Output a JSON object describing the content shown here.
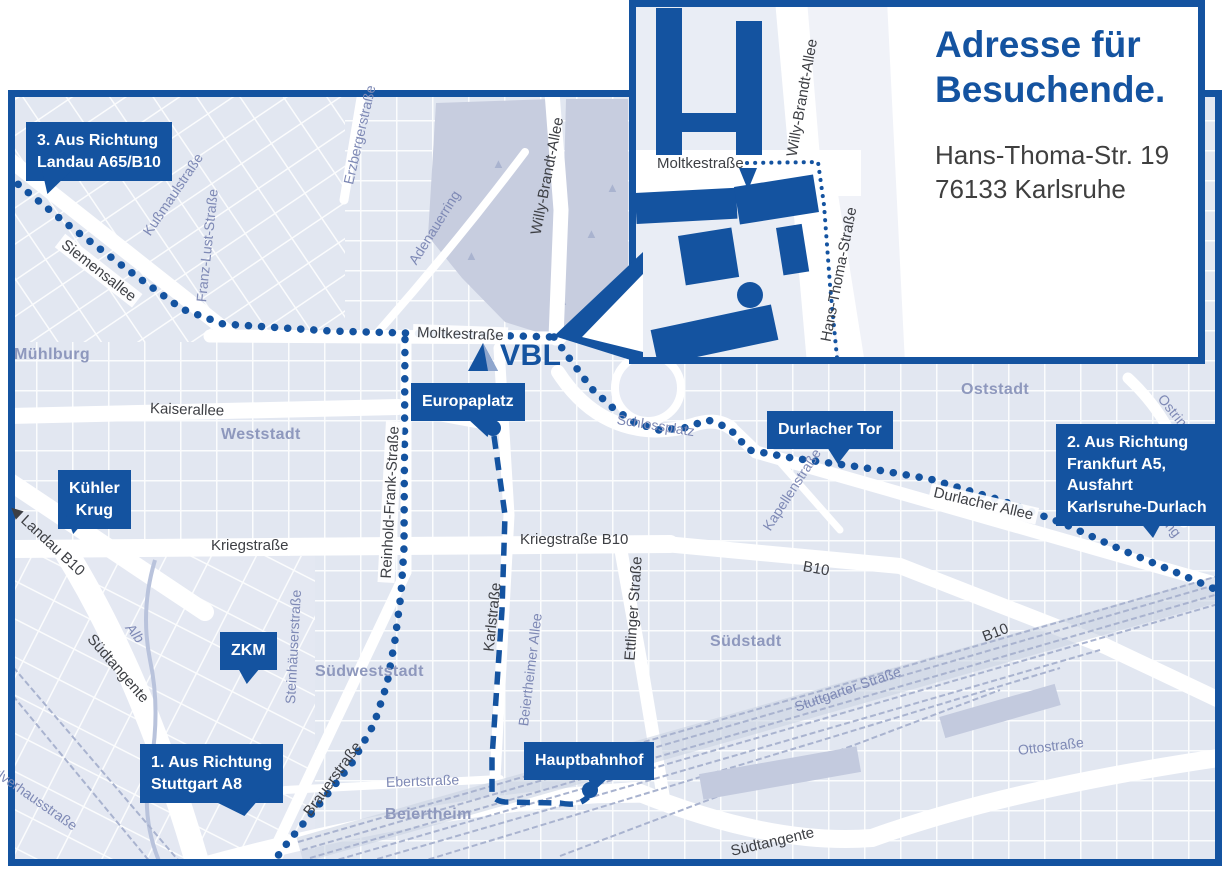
{
  "colors": {
    "accent": "#1453a0",
    "map_background": "#eef1f8",
    "block_fill": "#dfe4f0",
    "park_fill": "#c7cddf",
    "street_label_dark": "#3d3f44",
    "street_label_blue": "#7e89b5",
    "district_label": "#8e98bd",
    "railway": "#a9b3cf",
    "white_street": "#ffffff"
  },
  "logo": {
    "text": "VBL"
  },
  "inset": {
    "title_line1": "Adresse für",
    "title_line2": "Besuchende.",
    "address_line1": "Hans-Thoma-Str. 19",
    "address_line2": "76133 Karlsruhe",
    "street_moltkestrasse": "Moltkestraße",
    "street_willy_brandt_allee": "Willy-Brandt-Allee",
    "street_hans_thoma_strasse": "Hans-Thoma-Straße"
  },
  "badges": {
    "landau": {
      "line1": "3. Aus Richtung",
      "line2": "Landau A65/B10"
    },
    "frankfurt": {
      "line1": "2. Aus Richtung",
      "line2": "Frankfurt A5,",
      "line3": "Ausfahrt",
      "line4": "Karlsruhe-Durlach"
    },
    "stuttgart": {
      "line1": "1. Aus Richtung",
      "line2": "Stuttgart A8"
    },
    "kuehler_krug": {
      "line1": "Kühler",
      "line2": "Krug"
    },
    "zkm": {
      "label": "ZKM"
    },
    "europaplatz": {
      "label": "Europaplatz"
    },
    "durlacher_tor": {
      "label": "Durlacher Tor"
    },
    "hauptbahnhof": {
      "label": "Hauptbahnhof"
    }
  },
  "districts": {
    "muehlburg": "Mühlburg",
    "weststadt": "Weststadt",
    "oststadt": "Oststadt",
    "suedweststadt": "Südweststadt",
    "suedstadt": "Südstadt",
    "beiertheim": "Beiertheim"
  },
  "streets": {
    "siemensallee": "Siemensallee",
    "kussmaulstrasse": "Kußmaulstraße",
    "franz_lust_strasse": "Franz-Lust-Straße",
    "erzbergerstrasse": "Erzbergerstraße",
    "adenauerring": "Adenauerring",
    "willy_brandt_allee": "Willy-Brandt-Allee",
    "moltkestrasse": "Moltkestraße",
    "kaiserallee": "Kaiserallee",
    "reinhold_frank_strasse": "Reinhold-Frank-Straße",
    "kriegstrasse": "Kriegstraße",
    "kriegstrasse_b10": "Kriegstraße B10",
    "landau_arrow": "◀",
    "landau_b10": "Landau B10",
    "suedtangente": "Südtangente",
    "alb": "Alb",
    "steinhaeuserstrasse": "Steinhäuserstraße",
    "pulverhausstrasse": "Pulverhausstraße",
    "brauerstrasse": "Brauerstraße",
    "karlstrasse": "Karlstraße",
    "ebertstrasse": "Ebertstraße",
    "beiertheimer_allee": "Beiertheimer Allee",
    "ettlinger_strasse": "Ettlinger Straße",
    "stuttgarter_strasse": "Stuttgarter Straße",
    "durlacher_allee": "Durlacher Allee",
    "kapellenstrasse": "Kapellenstraße",
    "ostring": "Ostring",
    "ottostrasse": "Ottostraße",
    "b10": "B10",
    "schlossplatz": "Schlossplatz"
  }
}
